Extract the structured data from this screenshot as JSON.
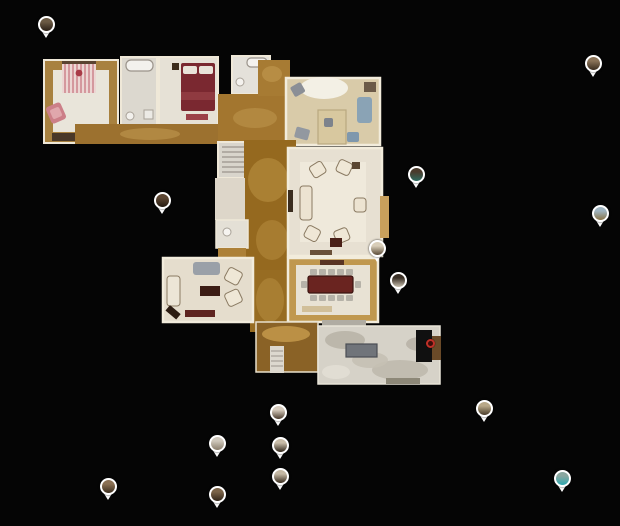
{
  "app": {
    "name": "3d-tour-floorplan-view",
    "background_color": "#050505"
  },
  "colors": {
    "pin_border": "#ffffff",
    "view_marker_ring": "#c03028",
    "wood_floor": "#9c712f",
    "cream_floor": "#e7e0d2",
    "stone_floor": "#d6d2c8"
  },
  "icons": [
    {
      "name": "map-pin",
      "meaning": "panorama position marker",
      "count": 15
    },
    {
      "name": "view-point-marker",
      "meaning": "current view point",
      "count": 1
    }
  ],
  "view_marker": {
    "x": 430,
    "y": 343
  },
  "pins": [
    {
      "id": 1,
      "x": 46,
      "y": 24,
      "thumb_top": "#6b5a44",
      "thumb_bottom": "#2a1f16"
    },
    {
      "id": 2,
      "x": 593,
      "y": 63,
      "thumb_top": "#8a7358",
      "thumb_bottom": "#3a2c1e"
    },
    {
      "id": 3,
      "x": 416,
      "y": 174,
      "thumb_top": "#4a3b2c",
      "thumb_bottom": "#2e6b60"
    },
    {
      "id": 4,
      "x": 600,
      "y": 213,
      "thumb_top": "#9fb4c0",
      "thumb_bottom": "#8a7448"
    },
    {
      "id": 5,
      "x": 162,
      "y": 200,
      "thumb_top": "#5c4632",
      "thumb_bottom": "#241a10"
    },
    {
      "id": 6,
      "x": 377,
      "y": 248,
      "thumb_top": "#d8cdb8",
      "thumb_bottom": "#5a4a36"
    },
    {
      "id": 7,
      "x": 398,
      "y": 280,
      "thumb_top": "#3a3026",
      "thumb_bottom": "#c8bfae"
    },
    {
      "id": 8,
      "x": 484,
      "y": 408,
      "thumb_top": "#b8a888",
      "thumb_bottom": "#4a3c2a"
    },
    {
      "id": 9,
      "x": 562,
      "y": 478,
      "thumb_top": "#8aa7a0",
      "thumb_bottom": "#2ea8b0"
    },
    {
      "id": 10,
      "x": 278,
      "y": 412,
      "thumb_top": "#d5cabc",
      "thumb_bottom": "#4a3b2c"
    },
    {
      "id": 11,
      "x": 217,
      "y": 443,
      "thumb_top": "#cfc8bc",
      "thumb_bottom": "#8a7e6c"
    },
    {
      "id": 12,
      "x": 280,
      "y": 445,
      "thumb_top": "#c8bca8",
      "thumb_bottom": "#32281c"
    },
    {
      "id": 13,
      "x": 280,
      "y": 476,
      "thumb_top": "#c4b8a4",
      "thumb_bottom": "#3a2e20"
    },
    {
      "id": 14,
      "x": 217,
      "y": 494,
      "thumb_top": "#7a6348",
      "thumb_bottom": "#32261a"
    },
    {
      "id": 15,
      "x": 108,
      "y": 486,
      "thumb_top": "#8a7054",
      "thumb_bottom": "#3c2e1e"
    }
  ]
}
